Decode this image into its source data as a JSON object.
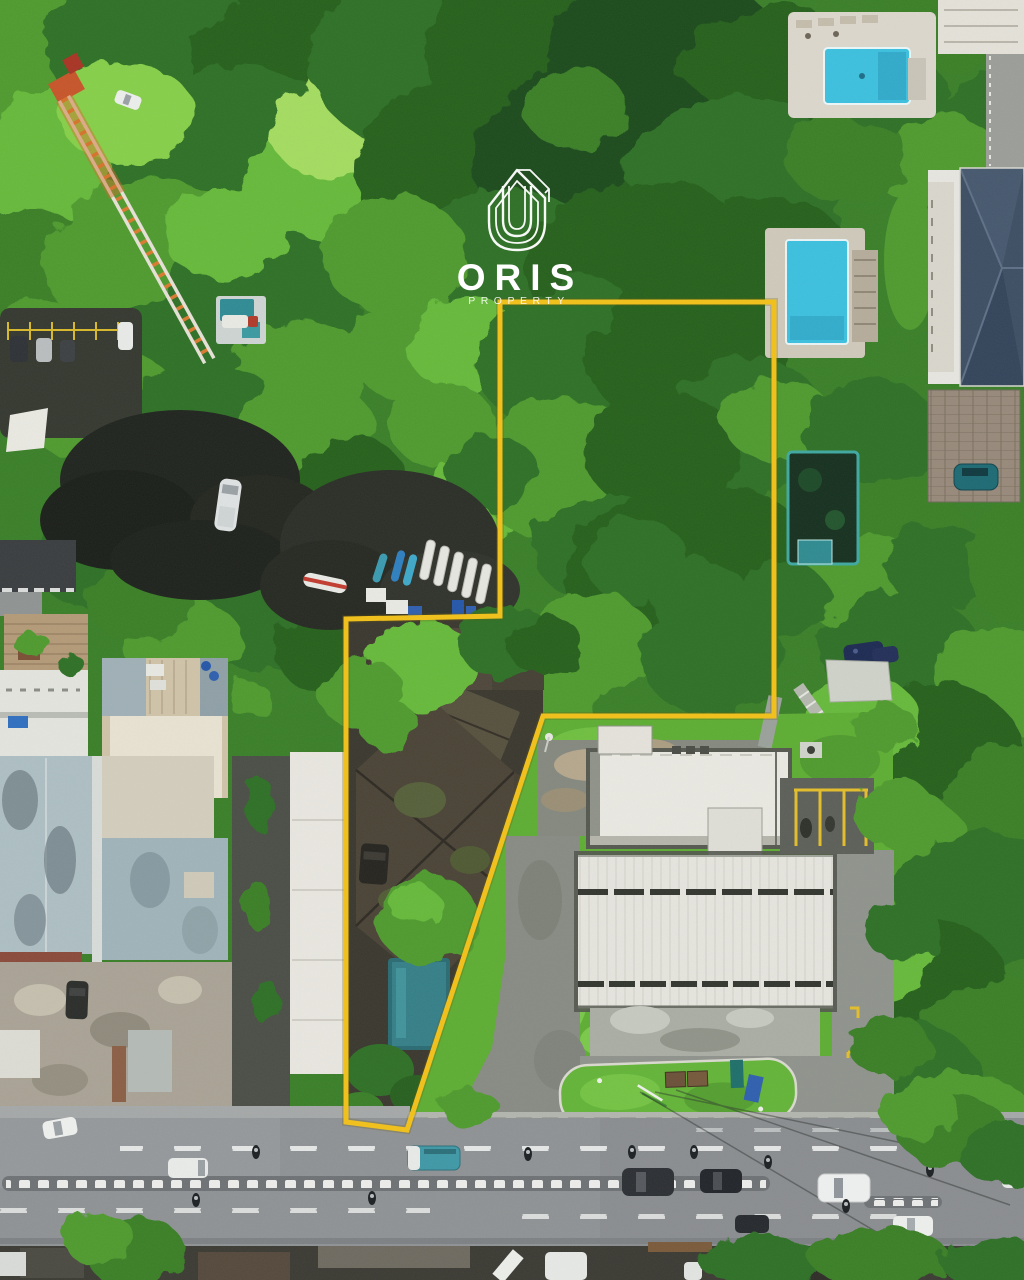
{
  "watermark": {
    "brand": "ORIS",
    "tagline": "PROPERTY"
  },
  "palette": {
    "boundary_yellow": "#F0C11E",
    "pool_cyan": "#3CC0DE",
    "lawn_green": "#5DAD33",
    "road_gray": "#8E9294",
    "roof_navy": "#3D4E63",
    "old_roof_brown": "#4A4336",
    "white_roof": "#E9E8E1",
    "foliage_dark": "#27601F",
    "foliage_bright": "#66B93A"
  },
  "scene": {
    "type": "aerial-drone-photo",
    "features": [
      "yellow-property-boundary",
      "tropical-tree-canopy",
      "heritage-tile-roof-houses",
      "office-buildings-white-metal-roof",
      "residential-swimming-pools",
      "small-pool-inside-plot",
      "construction-crane",
      "boat-storage-yard",
      "main-road-with-traffic",
      "grass-median-island",
      "parked-and-moving-vehicles"
    ]
  }
}
